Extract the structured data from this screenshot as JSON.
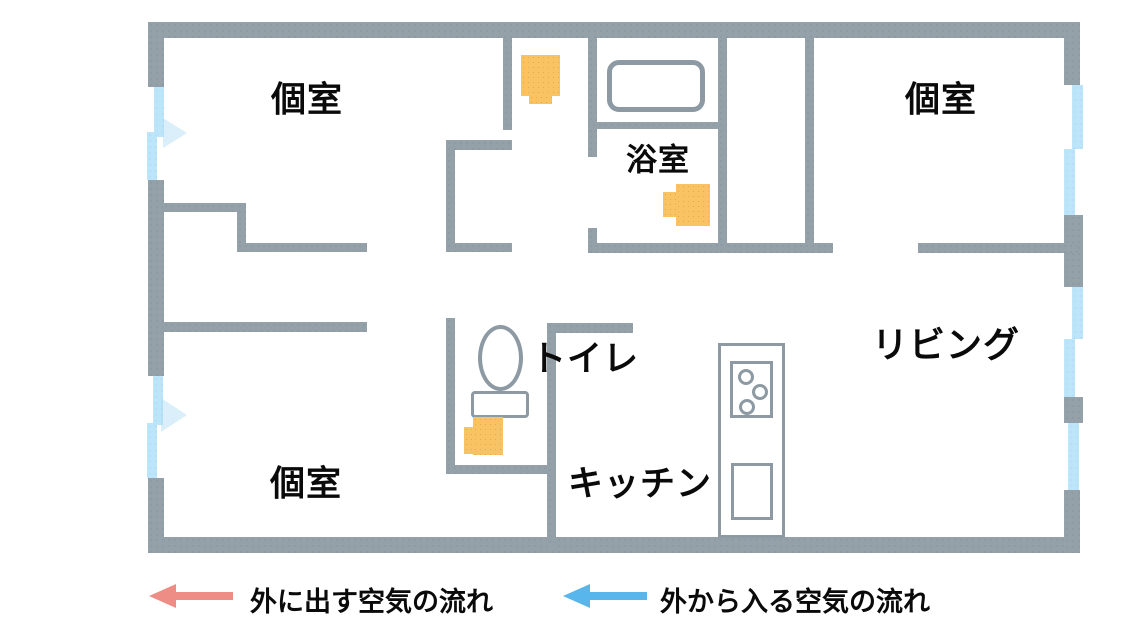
{
  "figure": {
    "type": "floor-plan",
    "description_visible_text_only": true
  },
  "rooms": {
    "bedroom_top_left": {
      "label": "個室"
    },
    "bedroom_top_right": {
      "label": "個室"
    },
    "bedroom_bottom_left": {
      "label": "個室"
    },
    "bathroom": {
      "label": "浴室"
    },
    "toilet": {
      "label": "トイレ"
    },
    "kitchen": {
      "label": "キッチン"
    },
    "living": {
      "label": "リビング"
    }
  },
  "legend": {
    "exhaust": {
      "label": "外に出す空気の流れ",
      "arrow_color": "#ee8d85",
      "arrow_direction": "left"
    },
    "intake": {
      "label": "外から入る空気の流れ",
      "arrow_color": "#58b6ec",
      "arrow_direction": "left"
    }
  },
  "icons": {
    "exhaust_fan": "exhaust-fan-icon",
    "bathtub": "bathtub-icon",
    "toilet": "toilet-icon",
    "stove": "stove-icon",
    "sink": "sink-icon",
    "air_intake_vent": "air-intake-vent",
    "intake_flow_hint": "intake-flow-arrow"
  },
  "colors": {
    "wall_gray": "#95a1a9",
    "vent_blue": "#bce5fa",
    "fan_orange": "#f9c263",
    "exhaust_arrow": "#ee8d85",
    "intake_arrow": "#58b6ec",
    "text": "#0a0a0a"
  }
}
